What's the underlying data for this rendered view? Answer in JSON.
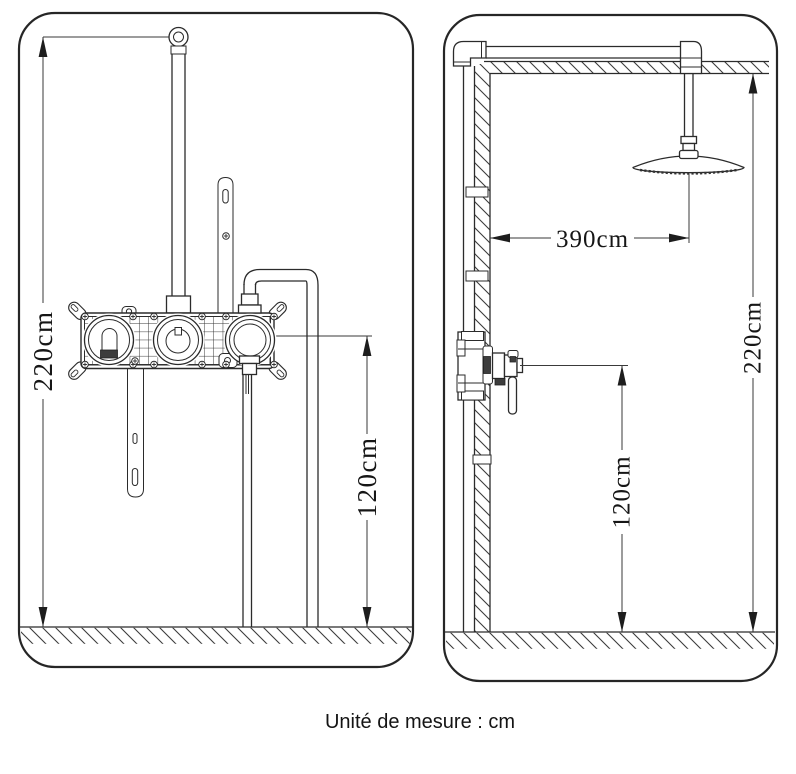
{
  "caption": "Unité de mesure : cm",
  "unit": "cm",
  "front_view": {
    "total_height_label": "220cm",
    "valve_height_label": "120cm"
  },
  "side_view": {
    "wall_to_head_label": "390cm",
    "total_height_label": "220cm",
    "valve_height_label": "120cm"
  },
  "colors": {
    "line": "#2b2b2b",
    "dimension": "#3a3a3a",
    "text": "#161616",
    "background": "#ffffff"
  }
}
